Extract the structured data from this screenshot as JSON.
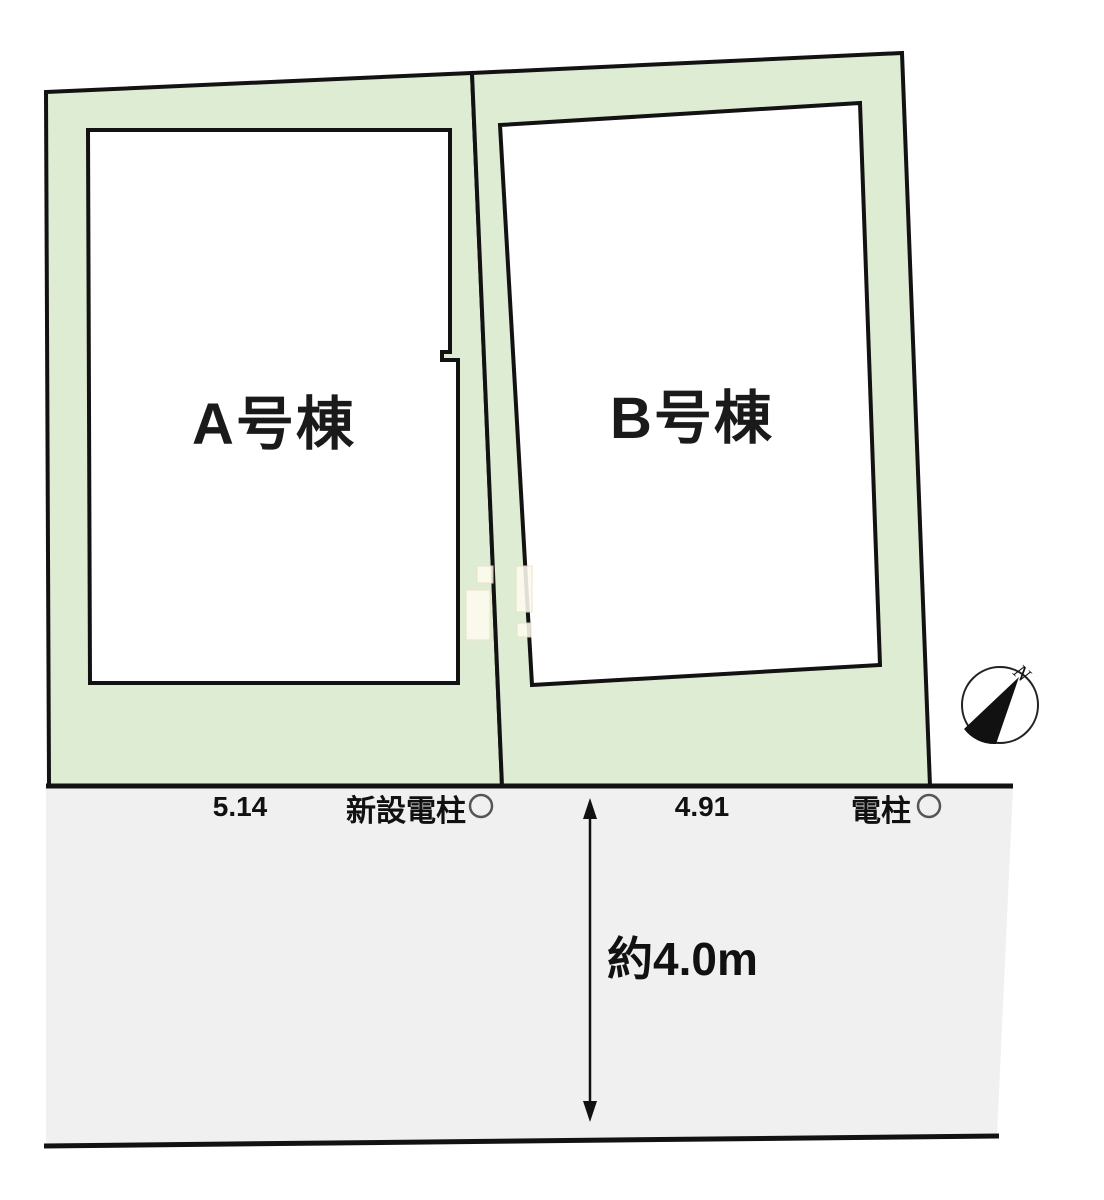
{
  "site_plan": {
    "title_context": "housing lot layout plan",
    "lots": [
      {
        "id": "A",
        "label": "A号棟"
      },
      {
        "id": "B",
        "label": "B号棟"
      }
    ],
    "road": {
      "dimension_left": "5.14",
      "dimension_right": "4.91",
      "pole_new_label": "新設電柱",
      "pole_label": "電柱",
      "road_width_label": "約4.0m"
    },
    "compass": {
      "north_label": "N"
    },
    "colors": {
      "parcel_green": "#dfecd4",
      "road_gray": "#f0f0f0",
      "line_black": "#121212",
      "building_white": "#ffffff"
    }
  }
}
